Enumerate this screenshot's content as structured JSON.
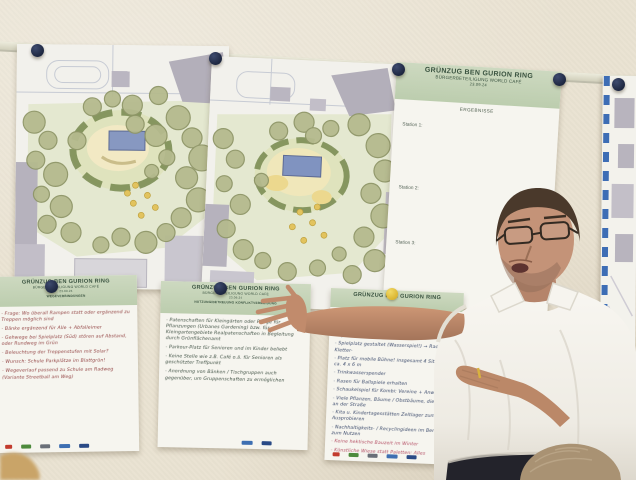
{
  "palette": {
    "wall": "#eae3d2",
    "poster_header_green": "#c3d2b5",
    "header_text_green": "#3a5340",
    "pin_navy": "#273253",
    "magnet_yellow": "#e5c545",
    "ink_red": "#8e3b3b",
    "ink_green": "#37493c",
    "ink_blue": "#2f3f63",
    "ink_pink": "#b2485f",
    "map_tree_sage": "#b5ba8e",
    "map_park_green": "#e4e8d0",
    "map_building_gray": "#b3afba",
    "map_accent_blue": "#8798c1",
    "side_map_dash_blue": "#3d6db5",
    "shirt_white": "#f6f4ee",
    "skin": "#c79171"
  },
  "results_poster": {
    "title": "GRÜNZUG BEN GURION RING",
    "subtitle": "BÜRGERBETEILIGUNG WORLD CAFÉ",
    "date": "23.09.24",
    "section": "ERGEBNISSE",
    "stations": [
      "Station 1:",
      "Station 2:",
      "Station 3:"
    ]
  },
  "flip_posters": [
    {
      "title": "GRÜNZUG BEN GURION RING",
      "subtitle": "BÜRGERBETEILIGUNG WORLD CAFÉ",
      "date": "23.09.24",
      "section": "WEGEVERBINDUNGEN",
      "items": [
        "- Frage: Wo überall Rampen statt oder ergänzend zu Treppen möglich sind",
        "- Bänke ergänzend für Alle + Abfalleimer",
        "- Gehwege bei Spielplatz (Süd) stören auf Abstand, oder Rundweg im Grün",
        "- Beleuchtung der Treppenstufen mit Solar?",
        "- Wunsch: Schule Parkplätze im Blattgrün!",
        "- Wegeverlauf passend zu Schule am Radweg (Variante Streetball am Weg)"
      ]
    },
    {
      "title": "GRÜNZUG BEN GURION RING",
      "subtitle": "BÜRGERBETEILIGUNG WORLD CAFÉ",
      "date": "23.09.24",
      "section": "NUTZUNG/BETREUUNG KONFLIKTVERMEIDUNG",
      "items": [
        "- Patenschaften für Kleingärten oder Pflege für Pflanzungen (Urbanes Gardening) bzw. für Kleingartengebiete Realpatenschaften in Begleitung durch Grünflächenamt",
        "- Parkour-Platz für Senioren und im Kinder beliebt",
        "- Keine Stelle wie z.B. Café o.ä. für Senioren als geschützter Treffpunkt",
        "- Anordnung von Bänken / Tischgruppen auch gegenüber, um Gruppenschaften zu ermöglichen"
      ]
    },
    {
      "title": "GRÜNZUG BEN GURION RING",
      "subtitle": "",
      "date": "",
      "section": "",
      "items": [
        "- Sport",
        "- Spielplatz gestaltet (Wasserspiel!) → Rad-, Tret-, Kletter-",
        "- Platz für mobile Bühne! insgesamt 4 Sitzstufen ca. 4 x 6 m",
        "- Trinkwasserspender",
        "- Rasen für Ballspiele erhalten",
        "- Schaukelspiel für Kombi: Vereine + Anwohner",
        "- Viele Pflanzen, Bäume / Obstbäume, die direkt an der Straße",
        "- Kita u. Kindertagesstätten Zeltlager zum Ausprobieren",
        "- Nachhaltigkeits- / Recyclingideen im Bereich zum Nutzen",
        "- Keine hektische Bauzeit im Winter",
        "- Künstliche Wiese statt Paletten: Alles"
      ]
    }
  ],
  "partner_logos": [
    "red-logo",
    "green-logo",
    "gray-logo",
    "blue-logo",
    "navy-logo"
  ]
}
